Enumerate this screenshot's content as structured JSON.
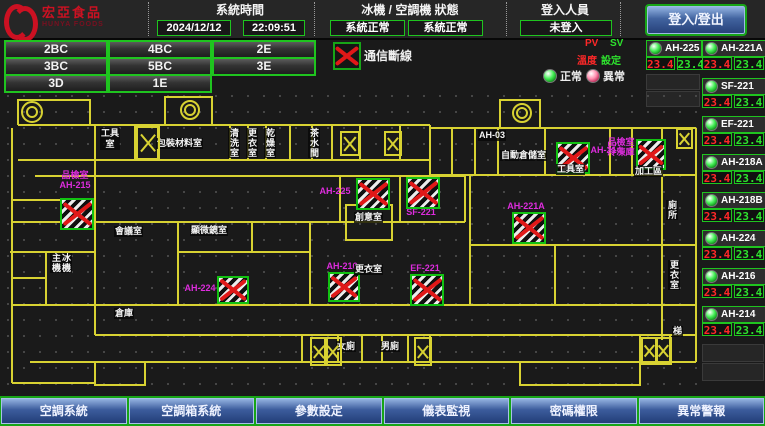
{
  "colors": {
    "accent_green": "#1fc41f",
    "alarm_red": "#e01818",
    "digital_green": "#2ee22e",
    "digital_red": "#ff2828",
    "magenta": "#dd2cdd",
    "wall_yellow": "#d8d232",
    "button_blue": "#3c5c9c"
  },
  "header": {
    "logo": {
      "brand": "宏亞食品",
      "brand_en": "HUNYA FOODS"
    },
    "system_time": {
      "label": "系統時間",
      "date": "2024/12/12",
      "time": "22:09:51"
    },
    "machine_status": {
      "label": "冰機 / 空調機 狀態",
      "chiller": "系統正常",
      "ac": "系統正常"
    },
    "login": {
      "label": "登入人員",
      "value": "未登入",
      "button": "登入/登出"
    }
  },
  "floor_buttons": [
    "2BC",
    "4BC",
    "2E",
    "3BC",
    "5BC",
    "3E",
    "3D",
    "1E"
  ],
  "legend": {
    "comm_loss": "通信斷線",
    "pv": "PV",
    "sv": "SV",
    "pv_cn": "溫度",
    "sv_cn": "設定",
    "normal": "正常",
    "abnormal": "異常"
  },
  "units": {
    "col_a": [
      {
        "name": "AH-225",
        "pv": "23.4",
        "sv": "23.4",
        "status": "normal"
      }
    ],
    "col_a_empty": 2,
    "col_b": [
      {
        "name": "AH-221A",
        "pv": "23.4",
        "sv": "23.4",
        "status": "normal"
      },
      {
        "name": "SF-221",
        "pv": "23.4",
        "sv": "23.4",
        "status": "normal"
      },
      {
        "name": "EF-221",
        "pv": "23.4",
        "sv": "23.4",
        "status": "normal"
      },
      {
        "name": "AH-218A",
        "pv": "23.4",
        "sv": "23.4",
        "status": "normal"
      },
      {
        "name": "AH-218B",
        "pv": "23.4",
        "sv": "23.4",
        "status": "normal"
      },
      {
        "name": "AH-224",
        "pv": "23.4",
        "sv": "23.4",
        "status": "normal"
      },
      {
        "name": "AH-216",
        "pv": "23.4",
        "sv": "23.4",
        "status": "normal"
      },
      {
        "name": "AH-214",
        "pv": "23.4",
        "sv": "23.4",
        "status": "normal"
      }
    ],
    "col_b_empty": 2
  },
  "floorplan": {
    "equipment": [
      {
        "label": "品檢室\nAH-215",
        "x": 60,
        "y": 110,
        "w": 30,
        "h": 28,
        "lx": 48,
        "ly": 82,
        "lw": 54,
        "comm_loss": true
      },
      {
        "label": "AH-225",
        "x": 356,
        "y": 90,
        "w": 30,
        "h": 28,
        "lx": 316,
        "ly": 98,
        "lw": 38,
        "comm_loss": true
      },
      {
        "label": "SF-221",
        "x": 406,
        "y": 89,
        "w": 30,
        "h": 28,
        "lx": 402,
        "ly": 119,
        "lw": 38,
        "comm_loss": true
      },
      {
        "label": "AH-221A",
        "x": 512,
        "y": 124,
        "w": 30,
        "h": 28,
        "lx": 504,
        "ly": 113,
        "lw": 44,
        "comm_loss": true
      },
      {
        "label": "AH-216",
        "x": 328,
        "y": 184,
        "w": 28,
        "h": 26,
        "lx": 322,
        "ly": 173,
        "lw": 40,
        "comm_loss": true
      },
      {
        "label": "EF-221",
        "x": 410,
        "y": 186,
        "w": 30,
        "h": 28,
        "lx": 406,
        "ly": 175,
        "lw": 38,
        "comm_loss": true
      },
      {
        "label": "AH-224",
        "x": 217,
        "y": 188,
        "w": 28,
        "h": 24,
        "lx": 184,
        "ly": 195,
        "lw": 32,
        "comm_loss": true
      },
      {
        "label": "AH-214",
        "x": 556,
        "y": 54,
        "w": 30,
        "h": 28,
        "lx": 588,
        "ly": 57,
        "lw": 36,
        "comm_loss": true
      },
      {
        "label": "品檢室\n冷凍庫",
        "x": 636,
        "y": 51,
        "w": 26,
        "h": 27,
        "lx": 606,
        "ly": 49,
        "lw": 30,
        "comm_loss": true
      }
    ],
    "rooms": [
      {
        "text": "工具\n室",
        "x": 100,
        "y": 40
      },
      {
        "text": "包裝材料室",
        "x": 156,
        "y": 50
      },
      {
        "text": "清洗室",
        "x": 228,
        "y": 40,
        "vertical": true
      },
      {
        "text": "更衣室",
        "x": 246,
        "y": 40,
        "vertical": true
      },
      {
        "text": "乾燥室",
        "x": 264,
        "y": 40,
        "vertical": true
      },
      {
        "text": "茶水間",
        "x": 308,
        "y": 40,
        "vertical": true
      },
      {
        "text": "AH-03",
        "x": 478,
        "y": 42
      },
      {
        "text": "自動倉儲室",
        "x": 500,
        "y": 62
      },
      {
        "text": "工具室",
        "x": 556,
        "y": 76
      },
      {
        "text": "加工區",
        "x": 634,
        "y": 78
      },
      {
        "text": "創意室",
        "x": 354,
        "y": 124
      },
      {
        "text": "會議室",
        "x": 114,
        "y": 138
      },
      {
        "text": "顯微鏡室",
        "x": 190,
        "y": 137
      },
      {
        "text": "更衣室",
        "x": 354,
        "y": 176
      },
      {
        "text": "冰機\n主機",
        "x": 50,
        "y": 165,
        "vertical": true
      },
      {
        "text": "倉庫",
        "x": 114,
        "y": 220
      },
      {
        "text": "女廁",
        "x": 336,
        "y": 253
      },
      {
        "text": "男廁",
        "x": 380,
        "y": 253
      },
      {
        "text": "廁所",
        "x": 666,
        "y": 112,
        "vertical": true
      },
      {
        "text": "更衣室",
        "x": 668,
        "y": 172,
        "vertical": true
      },
      {
        "text": "梯",
        "x": 672,
        "y": 238
      }
    ],
    "stairs": [
      {
        "x": 136,
        "y": 38,
        "w": 20,
        "h": 30
      },
      {
        "x": 340,
        "y": 43,
        "w": 16,
        "h": 21
      },
      {
        "x": 384,
        "y": 43,
        "w": 14,
        "h": 21
      },
      {
        "x": 310,
        "y": 249,
        "w": 14,
        "h": 25
      },
      {
        "x": 324,
        "y": 249,
        "w": 14,
        "h": 25
      },
      {
        "x": 414,
        "y": 249,
        "w": 14,
        "h": 25
      },
      {
        "x": 641,
        "y": 249,
        "w": 13,
        "h": 24
      },
      {
        "x": 655,
        "y": 249,
        "w": 13,
        "h": 24
      },
      {
        "x": 676,
        "y": 40,
        "w": 13,
        "h": 17
      }
    ]
  },
  "bottom_nav": [
    "空調系統",
    "空調箱系統",
    "參數設定",
    "儀表監視",
    "密碼權限",
    "異常警報"
  ]
}
